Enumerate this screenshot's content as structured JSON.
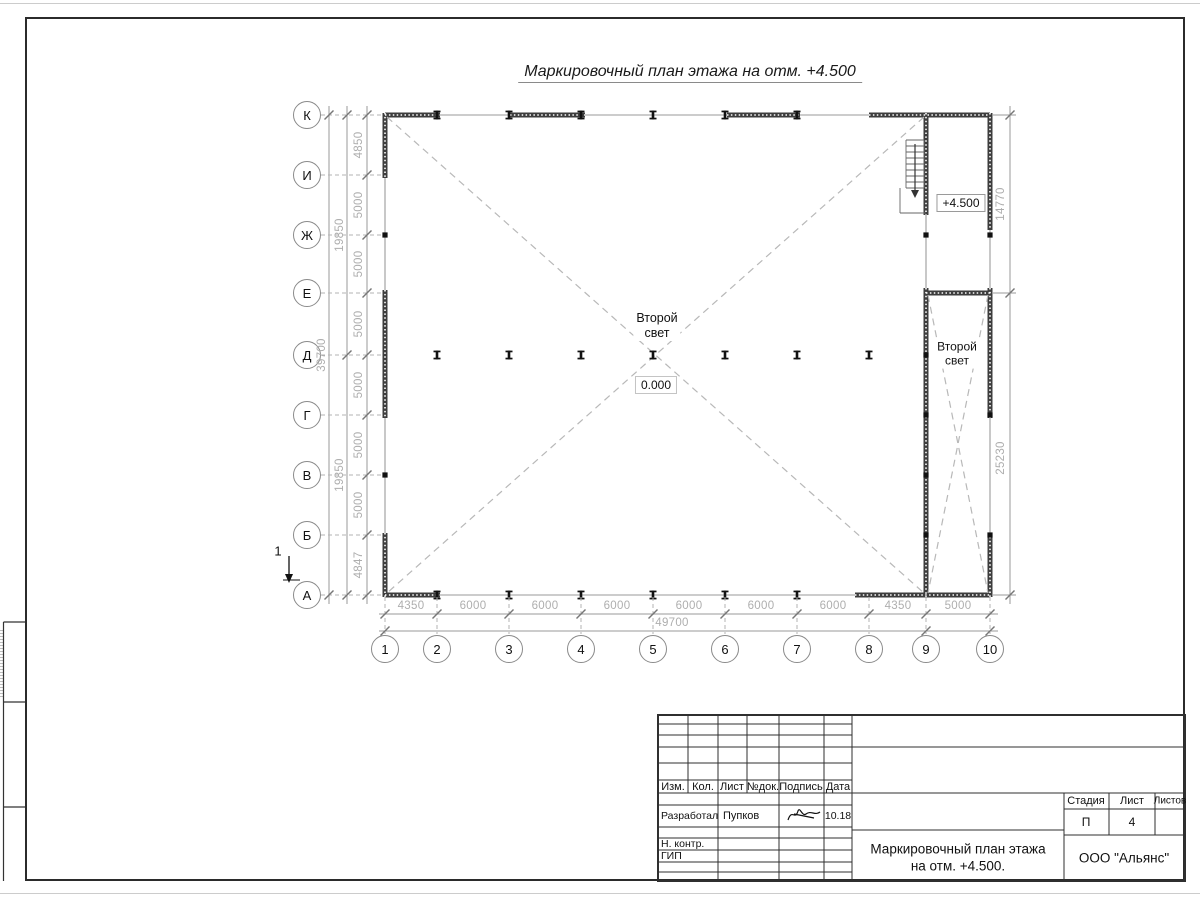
{
  "page": {
    "title": "Маркировочный план этажа на отм. +4.500"
  },
  "plan": {
    "row_axes": [
      "К",
      "И",
      "Ж",
      "Е",
      "Д",
      "Г",
      "В",
      "Б",
      "А"
    ],
    "col_axes": [
      "1",
      "2",
      "3",
      "4",
      "5",
      "6",
      "7",
      "8",
      "9",
      "10"
    ],
    "left_dims": [
      "4850",
      "5000",
      "5000",
      "5000",
      "5000",
      "5000",
      "5000",
      "4847"
    ],
    "left_subtotals": [
      "19850",
      "19850"
    ],
    "left_total": "39700",
    "bottom_dims": [
      "4350",
      "6000",
      "6000",
      "6000",
      "6000",
      "6000",
      "6000",
      "4350",
      "5000"
    ],
    "bottom_total": "49700",
    "right_dims": [
      "14770",
      "25230"
    ],
    "second_light_main": {
      "line1": "Второй",
      "line2": "свет"
    },
    "second_light_right": {
      "line1": "Второй",
      "line2": "свет"
    },
    "elevation_zero": "0.000",
    "elevation_upper": "+4.500",
    "section_mark": "1"
  },
  "titleblock": {
    "col_headers": [
      "Изм.",
      "Кол.",
      "Лист",
      "№док.",
      "Подпись",
      "Дата"
    ],
    "developed_label": "Разработал",
    "developed_name": "Пупков",
    "developed_date": "10.18",
    "ncontr_label": "Н. контр.",
    "gip_label": "ГИП",
    "doc_title_line1": "Маркировочный план этажа",
    "doc_title_line2": "на отм. +4.500.",
    "stage_label": "Стадия",
    "sheet_label": "Лист",
    "sheets_label": "Листов",
    "stage_value": "П",
    "sheet_value": "4",
    "company": "ООО \"Альянс\""
  }
}
